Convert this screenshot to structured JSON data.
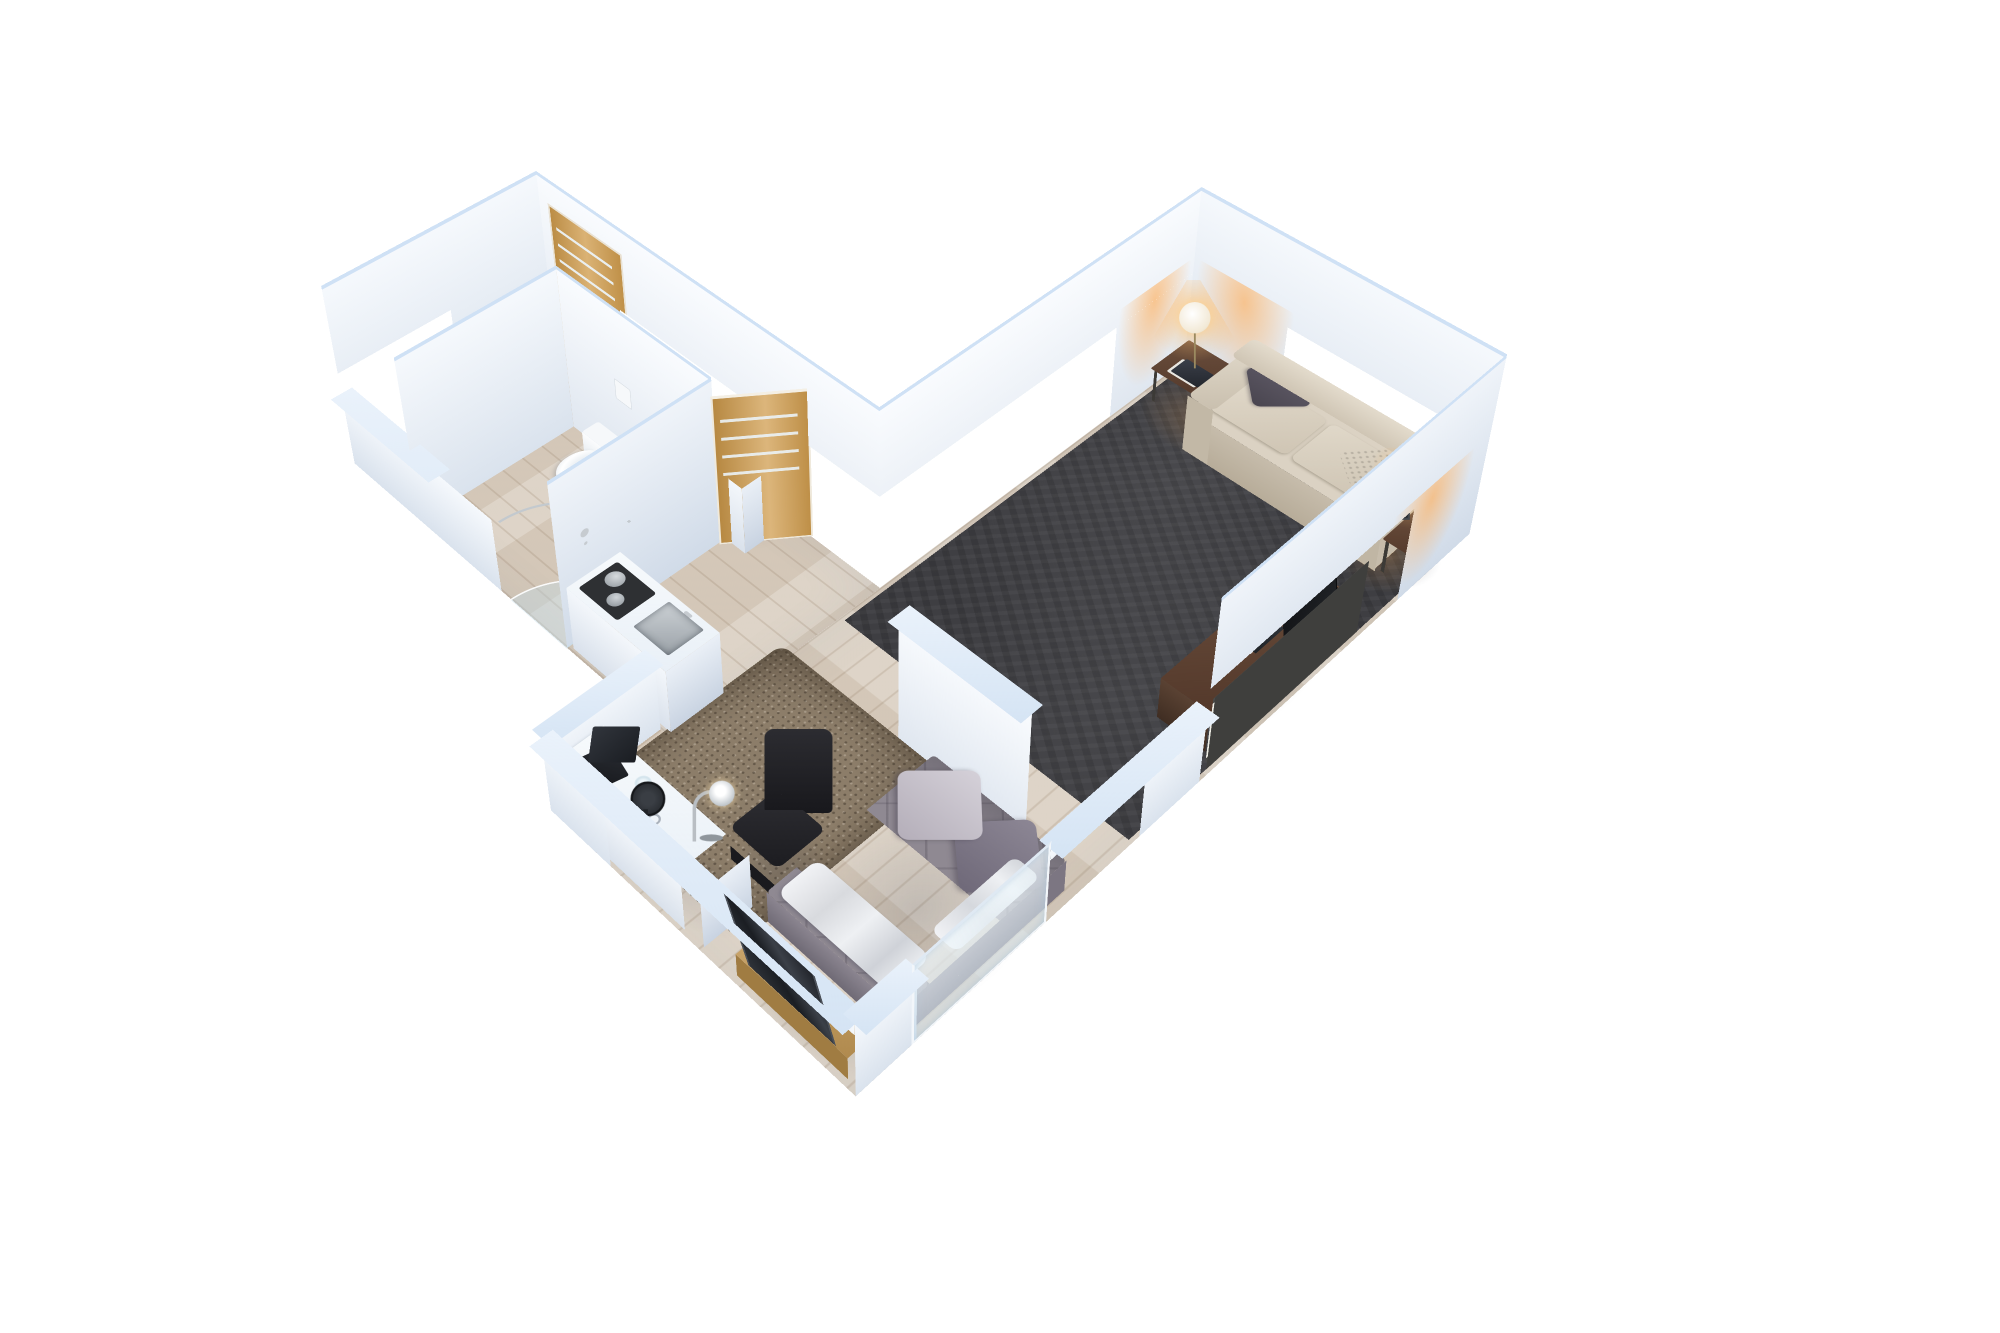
{
  "scene": {
    "type": "isometric-3d-floor-plan-render",
    "view": "dollhouse-cutaway-top-down",
    "background": "#ffffff",
    "apartment": {
      "layout": "v-shaped-studio",
      "rooms": [
        {
          "id": "hallway",
          "label": "Entrance hallway",
          "floor": "light-oak-planks",
          "items": [
            "oak-entrance-door-with-glass-stripes",
            "taupe-topped-sideboard"
          ]
        },
        {
          "id": "bathroom",
          "label": "Bathroom",
          "floor": "light-oak-planks",
          "items": [
            "wall-hung-toilet",
            "flush-plate",
            "corner-shower-glass",
            "chrome-shower-rail",
            "open-oak-door"
          ]
        },
        {
          "id": "kitchen",
          "label": "Kitchenette",
          "floor": "light-oak-planks",
          "items": [
            "white-counter",
            "inset-steel-sink",
            "black-cooktop",
            "steel-pots"
          ]
        },
        {
          "id": "living-room",
          "label": "Living room",
          "floor": "dark-charcoal-carpet",
          "items": [
            "beige-sofa",
            "dark-gray-cushion",
            "white-patterned-cushion",
            "side-table-with-globe-lamp-corner",
            "side-table-with-globe-lamp-right",
            "walnut-tv-sideboard",
            "leaning-flat-tv",
            "white-slat-radiator"
          ]
        },
        {
          "id": "sleeping-area",
          "label": "Sleeping area",
          "floor": "light-oak-planks",
          "items": [
            "gray-quilted-bed",
            "two-gray-pillows",
            "crumpled-white-duvet",
            "brown-shag-rug",
            "white-desk",
            "black-office-chair",
            "laptop",
            "chrome-desk-lamp",
            "black-desk-fan",
            "water-glass",
            "binders",
            "oak-bench",
            "dark-leaning-mirror",
            "partition-wall",
            "glass-sliding-panel-in-low-wall"
          ]
        }
      ]
    }
  },
  "colors": {
    "bg": "#ffffff",
    "wallFace": "#edf3fa",
    "wallBright": "#f4f8fd",
    "wallShade": "#e2eaf4",
    "wallCap": "#cfe1f5",
    "wood": "#d9cec0",
    "carpet": "#3e3e42",
    "rug": "#8c7d69",
    "sofa": "#dbd2c3",
    "sofaShade": "#c6bcab",
    "pillowDark": "#56525e",
    "pillowLight": "#ebe8e0",
    "oak": "#d2a156",
    "taupe": "#8b8276",
    "walnut": "#5e4536",
    "radiatorSlat": "#edece4",
    "radiatorFrame": "#454543",
    "tv": "#1b1d20",
    "mattress": "#8f8992",
    "bedPillowLight": "#c8c3cc",
    "bedPillowDark": "#7e7886",
    "duvet": "#eaebef",
    "chrome": "#c6cbd0",
    "black": "#26262a",
    "steel": "#b9bec3",
    "cooktop": "#2e3033",
    "counter": "#f2f5f8",
    "glass": "#d6e6f0",
    "glow": "#ffb368",
    "lamp": "#ffffff"
  }
}
